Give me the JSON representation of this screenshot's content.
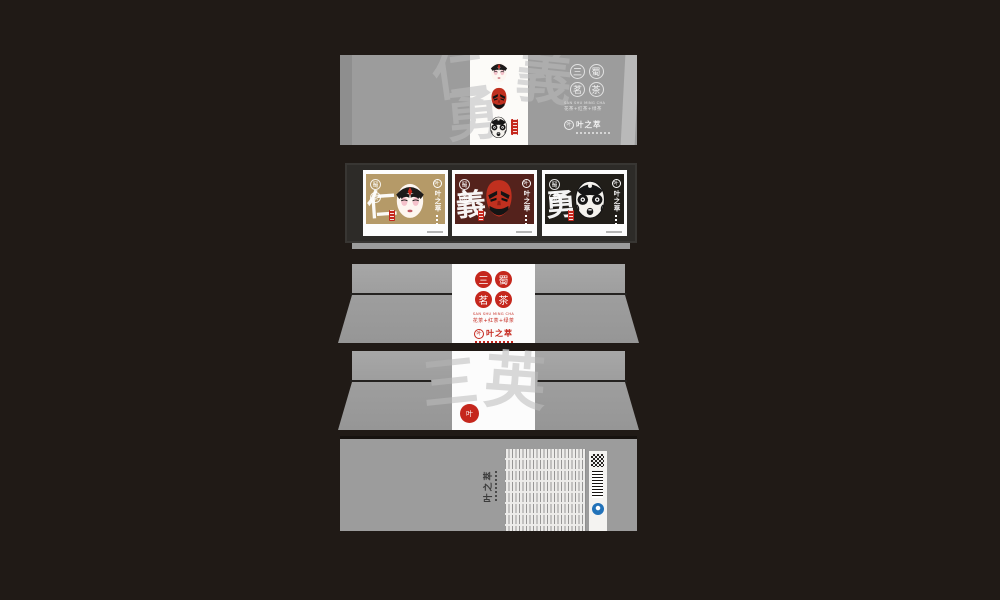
{
  "canvas": {
    "background": "#201a16",
    "box_gray": "#9c9c9c",
    "band_white": "#fcfbf8"
  },
  "brand": {
    "name": "叶之萃",
    "mark": "叶",
    "seal_red": "#c5271d",
    "qs_blue": "#2272b9"
  },
  "title_seals": {
    "chars": [
      "三",
      "蜀",
      "茗",
      "茶"
    ],
    "pinyin": "SAN SHU MING CHA",
    "variants_line": "花茶+红茶+绿茶"
  },
  "virtues": {
    "benevolence": "仁",
    "righteousness": "義",
    "courage": "勇"
  },
  "watermarks": {
    "lid_char1": "仁",
    "lid_char2": "義",
    "lid_char3": "勇",
    "back_char1": "三",
    "back_char2": "英"
  },
  "masks": {
    "top": "white-face-opera-mask",
    "middle": "red-face-opera-mask",
    "bottom": "black-face-opera-mask"
  },
  "cards": [
    {
      "virtue": "仁",
      "bg": "#b59a68",
      "mask": "white-face-opera-mask"
    },
    {
      "virtue": "義",
      "bg": "#54221c",
      "mask": "red-face-opera-mask"
    },
    {
      "virtue": "勇",
      "bg": "#211e19",
      "mask": "black-face-opera-mask"
    }
  ]
}
